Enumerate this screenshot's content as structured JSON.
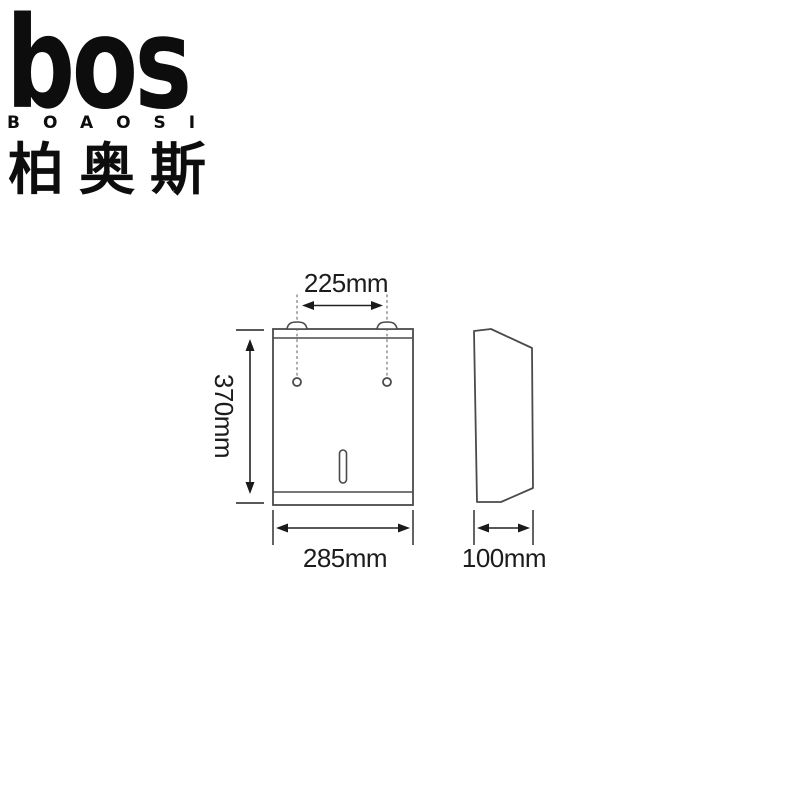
{
  "page": {
    "background": "#ffffff"
  },
  "brand": {
    "logo_text": "bos",
    "logo_subtext": "BOAOSI",
    "logo_chinese": "柏奥斯"
  },
  "diagram": {
    "front_view": {
      "hole_spacing_label": "225mm",
      "height_label": "370mm",
      "width_label": "285mm"
    },
    "side_view": {
      "depth_label": "100mm"
    },
    "colors": {
      "outline": "#4a4a4a",
      "dimension_line": "#222222",
      "label_text": "#1c1c1c",
      "dotted_guide": "#909090"
    }
  }
}
